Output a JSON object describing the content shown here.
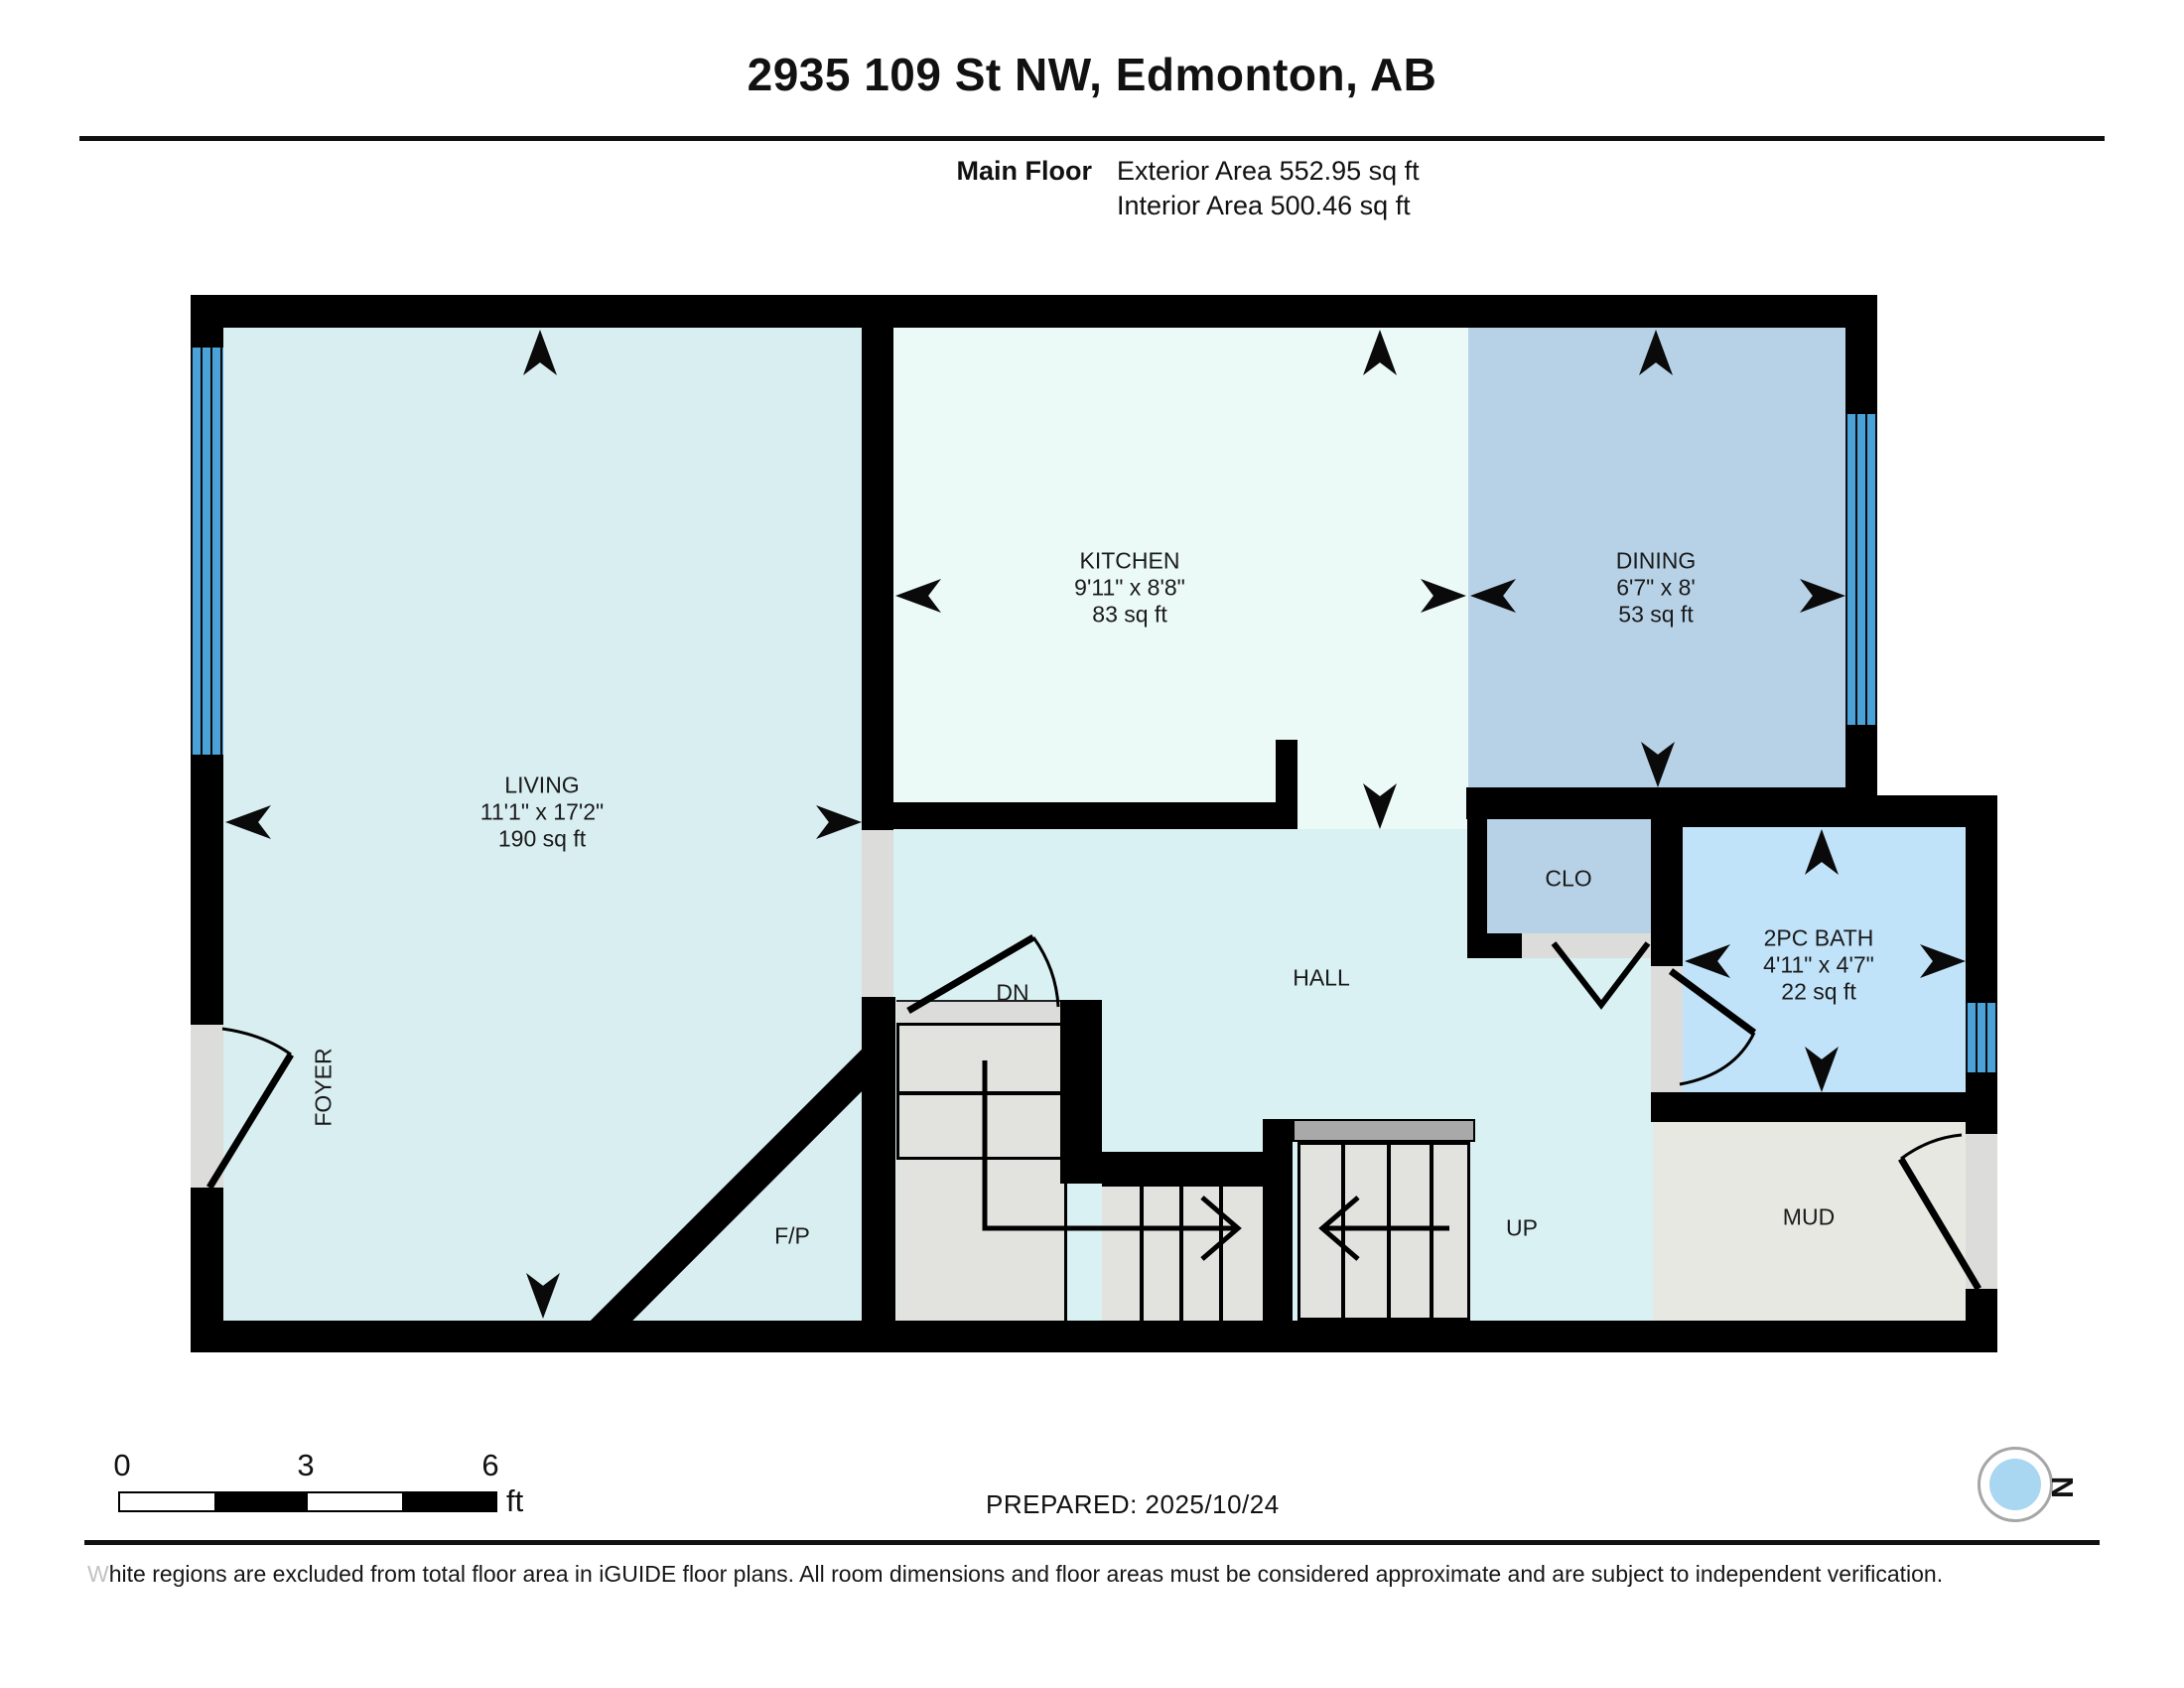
{
  "header": {
    "title": "2935 109 St NW, Edmonton, AB",
    "floor_label": "Main Floor",
    "exterior_area": "Exterior Area 552.95 sq ft",
    "interior_area": "Interior Area 500.46 sq ft"
  },
  "rooms": {
    "living": {
      "name": "LIVING",
      "dims": "11'1\" x 17'2\"",
      "area": "190 sq ft"
    },
    "kitchen": {
      "name": "KITCHEN",
      "dims": "9'11\" x 8'8\"",
      "area": "83 sq ft"
    },
    "dining": {
      "name": "DINING",
      "dims": "6'7\" x 8'",
      "area": "53 sq ft"
    },
    "bath": {
      "name": "2PC BATH",
      "dims": "4'11\" x 4'7\"",
      "area": "22 sq ft"
    },
    "clo": {
      "name": "CLO"
    },
    "hall": {
      "name": "HALL"
    },
    "foyer": {
      "name": "FOYER"
    },
    "fireplace": {
      "name": "F/P"
    },
    "mud": {
      "name": "MUD"
    },
    "stairs_down": {
      "name": "DN"
    },
    "stairs_up": {
      "name": "UP"
    }
  },
  "scale_bar": {
    "tick_0": "0",
    "tick_3": "3",
    "tick_6": "6",
    "unit": "ft"
  },
  "footer": {
    "prepared": "PREPARED: 2025/10/24",
    "compass_label": "N",
    "disclaimer": "White regions are excluded from total floor area in iGUIDE floor plans. All room dimensions and floor areas must be considered approximate and are subject to independent verification."
  },
  "colors": {
    "living_fill": "#d8eef1",
    "kitchen_fill": "#ebfaf7",
    "dining_fill": "#b7d2e7",
    "bath_fill": "#c1e3f9",
    "hall_fill": "#d9f1f3",
    "mud_fill": "#e8e8e3",
    "window_blue": "#4aa2d8",
    "wall_black": "#000000",
    "compass_red": "#e8191c"
  }
}
